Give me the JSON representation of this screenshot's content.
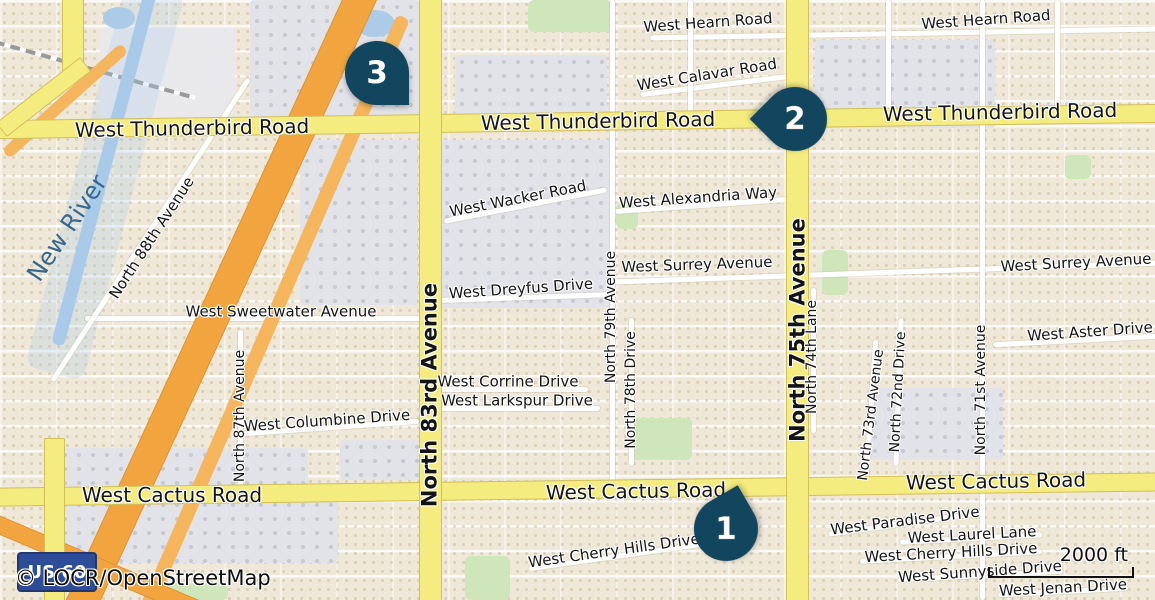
{
  "map": {
    "attribution": "© LOCR/OpenStreetMap",
    "scale": {
      "label": "2000 ft"
    },
    "shield": {
      "label": "US 60"
    },
    "colors": {
      "road_major_yellow": "#f5ec80",
      "highway_orange": "#f2a53f",
      "water_blue": "#a9c9e8",
      "marker_navy": "#12455e",
      "residential_beige": "#efe8d8",
      "commercial_gray": "#e2e3e8",
      "park_green": "#cfe6ba",
      "shield_blue": "#2e4d99",
      "river_label_blue": "#35688f"
    },
    "markers": [
      {
        "id": "1",
        "x": 726,
        "y": 529,
        "rot": -120
      },
      {
        "id": "2",
        "x": 795,
        "y": 119,
        "rot": 135
      },
      {
        "id": "3",
        "x": 377,
        "y": 73,
        "rot": 0
      }
    ],
    "features": [
      {
        "cls": "graylight",
        "name": "zone-riverside",
        "x": 100,
        "y": 28,
        "w": 135,
        "h": 100,
        "r": 0
      },
      {
        "cls": "gray",
        "name": "zone-commercial-nw",
        "x": 250,
        "y": 0,
        "w": 170,
        "h": 118,
        "r": 0
      },
      {
        "cls": "gray",
        "name": "zone-commercial-w83rd",
        "x": 300,
        "y": 140,
        "w": 118,
        "h": 165,
        "r": 0
      },
      {
        "cls": "gray",
        "name": "zone-commercial-e83rd",
        "x": 440,
        "y": 140,
        "w": 172,
        "h": 168,
        "r": 0
      },
      {
        "cls": "gray",
        "name": "zone-commercial-n-thunderbird",
        "x": 455,
        "y": 55,
        "w": 152,
        "h": 60,
        "r": 0
      },
      {
        "cls": "gray",
        "name": "zone-commercial-ne75th",
        "x": 815,
        "y": 40,
        "w": 180,
        "h": 88,
        "r": 0
      },
      {
        "cls": "gray",
        "name": "zone-commercial-center-east",
        "x": 868,
        "y": 388,
        "w": 135,
        "h": 72,
        "r": 0
      },
      {
        "cls": "gray",
        "name": "zone-commercial-cactus-nw",
        "x": 58,
        "y": 448,
        "w": 250,
        "h": 40,
        "r": 0
      },
      {
        "cls": "gray",
        "name": "zone-commercial-cactus-sw",
        "x": 58,
        "y": 498,
        "w": 280,
        "h": 65,
        "r": 0
      },
      {
        "cls": "gray",
        "name": "zone-commercial-cactus-83rd",
        "x": 340,
        "y": 440,
        "w": 80,
        "h": 40,
        "r": 0
      },
      {
        "cls": "green",
        "name": "park-top-center",
        "x": 528,
        "y": 0,
        "w": 84,
        "h": 32,
        "r": 0
      },
      {
        "cls": "green",
        "name": "park-alexandria",
        "x": 616,
        "y": 203,
        "w": 22,
        "h": 26,
        "r": 0
      },
      {
        "cls": "green",
        "name": "park-74th",
        "x": 822,
        "y": 250,
        "w": 26,
        "h": 45,
        "r": 0
      },
      {
        "cls": "green",
        "name": "park-center",
        "x": 632,
        "y": 418,
        "w": 60,
        "h": 42,
        "r": 0
      },
      {
        "cls": "green",
        "name": "park-bottom-center",
        "x": 465,
        "y": 556,
        "w": 45,
        "h": 44,
        "r": 0
      },
      {
        "cls": "green",
        "name": "park-right-top",
        "x": 1065,
        "y": 155,
        "w": 26,
        "h": 24,
        "r": 0
      },
      {
        "cls": "green",
        "name": "park-bottom-left",
        "x": 168,
        "y": 584,
        "w": 60,
        "h": 16,
        "r": 0
      },
      {
        "cls": "pond",
        "name": "pond-northwest",
        "x": 103,
        "y": 7,
        "w": 32,
        "h": 22,
        "r": 0
      },
      {
        "cls": "pond",
        "name": "pond-north",
        "x": 355,
        "y": 10,
        "w": 40,
        "h": 27,
        "r": 0
      },
      {
        "cls": "rail",
        "name": "railway",
        "x": -9,
        "y": 68,
        "w": 208,
        "h": 4,
        "r": 15.6
      },
      {
        "cls": "waterwide",
        "name": "new-river-floodway",
        "x": 75,
        "y": -20,
        "w": 60,
        "h": 400,
        "r": 14.8
      },
      {
        "cls": "water",
        "name": "new-river",
        "x": 98,
        "y": -17,
        "w": 13,
        "h": 368,
        "r": 14.8
      },
      {
        "cls": "street",
        "name": "west-hearn-road",
        "x": 650,
        "y": 31,
        "w": 507,
        "h": 5,
        "r": -1
      },
      {
        "cls": "street",
        "name": "west-calavar-road",
        "x": 640,
        "y": 83,
        "w": 150,
        "h": 5,
        "r": -7
      },
      {
        "cls": "street",
        "name": "west-wacker-road",
        "x": 443,
        "y": 203,
        "w": 165,
        "h": 5,
        "r": -11
      },
      {
        "cls": "street",
        "name": "west-alexandria-way",
        "x": 615,
        "y": 203,
        "w": 172,
        "h": 5,
        "r": -4
      },
      {
        "cls": "street",
        "name": "west-surrey-avenue",
        "x": 613,
        "y": 270,
        "w": 545,
        "h": 5,
        "r": -2
      },
      {
        "cls": "street",
        "name": "west-dreyfus-drive",
        "x": 440,
        "y": 295,
        "w": 172,
        "h": 5,
        "r": -2
      },
      {
        "cls": "street",
        "name": "west-sweetwater-avenue",
        "x": 85,
        "y": 316,
        "w": 345,
        "h": 5,
        "r": 0
      },
      {
        "cls": "street",
        "name": "west-aster-drive",
        "x": 993,
        "y": 338,
        "w": 165,
        "h": 5,
        "r": -3
      },
      {
        "cls": "street",
        "name": "west-corrine-drive",
        "x": 440,
        "y": 387,
        "w": 148,
        "h": 5,
        "r": 0
      },
      {
        "cls": "street",
        "name": "west-larkspur-drive",
        "x": 440,
        "y": 406,
        "w": 160,
        "h": 5,
        "r": 0
      },
      {
        "cls": "street",
        "name": "west-columbine-drive",
        "x": 243,
        "y": 425,
        "w": 176,
        "h": 5,
        "r": -4
      },
      {
        "cls": "street",
        "name": "west-cherry-hills-drive-c",
        "x": 528,
        "y": 554,
        "w": 175,
        "h": 5,
        "r": -8
      },
      {
        "cls": "street",
        "name": "west-paradise-drive",
        "x": 828,
        "y": 521,
        "w": 155,
        "h": 5,
        "r": -8
      },
      {
        "cls": "street",
        "name": "west-laurel-lane",
        "x": 900,
        "y": 536,
        "w": 142,
        "h": 5,
        "r": -3
      },
      {
        "cls": "street",
        "name": "west-cherry-hills-drive-r",
        "x": 860,
        "y": 554,
        "w": 182,
        "h": 5,
        "r": -3
      },
      {
        "cls": "street",
        "name": "west-sunnyside-drive",
        "x": 898,
        "y": 573,
        "w": 165,
        "h": 5,
        "r": -3
      },
      {
        "cls": "street",
        "name": "west-jenan-drive",
        "x": 998,
        "y": 589,
        "w": 130,
        "h": 5,
        "r": -3
      },
      {
        "cls": "street",
        "name": "north-87th-avenue",
        "x": 238,
        "y": 330,
        "w": 5,
        "h": 162,
        "r": 0
      },
      {
        "cls": "street",
        "name": "north-88th-avenue",
        "x": 148,
        "y": 50,
        "w": 5,
        "h": 360,
        "r": 33
      },
      {
        "cls": "street",
        "name": "north-79th-avenue",
        "x": 610,
        "y": 0,
        "w": 5,
        "h": 485,
        "r": 0
      },
      {
        "cls": "street",
        "name": "north-78th-drive",
        "x": 629,
        "y": 318,
        "w": 5,
        "h": 148,
        "r": 0
      },
      {
        "cls": "street",
        "name": "north-74th-lane",
        "x": 811,
        "y": 288,
        "w": 5,
        "h": 145,
        "r": 0
      },
      {
        "cls": "street",
        "name": "north-73rd-avenue",
        "x": 868,
        "y": 340,
        "w": 5,
        "h": 152,
        "r": 4
      },
      {
        "cls": "street",
        "name": "north-72nd-drive",
        "x": 896,
        "y": 318,
        "w": 5,
        "h": 148,
        "r": 2
      },
      {
        "cls": "street",
        "name": "north-71st-avenue",
        "x": 980,
        "y": 0,
        "w": 5,
        "h": 600,
        "r": 0
      },
      {
        "cls": "street",
        "name": "local-street-v1",
        "x": 688,
        "y": 0,
        "w": 5,
        "h": 118,
        "r": 0
      },
      {
        "cls": "street",
        "name": "local-street-v2",
        "x": 886,
        "y": 0,
        "w": 5,
        "h": 115,
        "r": 0
      },
      {
        "cls": "street",
        "name": "local-street-v3",
        "x": 1055,
        "y": 0,
        "w": 5,
        "h": 115,
        "r": 0
      },
      {
        "cls": "orange2",
        "name": "us60-ramp",
        "x": 267,
        "y": -10,
        "w": 14,
        "h": 650,
        "r": 23.5
      },
      {
        "cls": "orange",
        "name": "us60-freeway",
        "x": 205,
        "y": -50,
        "w": 30,
        "h": 700,
        "r": 24.7
      },
      {
        "cls": "orange",
        "name": "us60-ramp-southwest",
        "x": -20,
        "y": 557,
        "w": 230,
        "h": 16,
        "r": 23
      },
      {
        "cls": "orange2",
        "name": "ramp-northwest",
        "x": -15,
        "y": 95,
        "w": 160,
        "h": 12,
        "r": -42
      },
      {
        "cls": "yellow",
        "name": "west-thunderbird-road-band",
        "x": -8,
        "y": 112,
        "w": 1171,
        "h": 17,
        "r": -0.8
      },
      {
        "cls": "yellow",
        "name": "west-cactus-road-band",
        "x": -8,
        "y": 480,
        "w": 1171,
        "h": 17,
        "r": -0.75
      },
      {
        "cls": "yellow",
        "name": "north-83rd-avenue-band",
        "x": 419,
        "y": -6,
        "w": 21,
        "h": 612,
        "r": 0
      },
      {
        "cls": "yellow",
        "name": "north-75th-avenue-band",
        "x": 786,
        "y": -6,
        "w": 21,
        "h": 612,
        "r": 0
      },
      {
        "cls": "yellow",
        "name": "yellow-road-topleft",
        "x": 62,
        "y": -4,
        "w": 20,
        "h": 80,
        "r": 0
      },
      {
        "cls": "yellow",
        "name": "yellow-connector-topleft",
        "x": -10,
        "y": 88,
        "w": 105,
        "h": 16,
        "r": -38
      },
      {
        "cls": "yellow",
        "name": "yellow-road-bottomleft",
        "x": 44,
        "y": 438,
        "w": 19,
        "h": 165,
        "r": 0
      }
    ],
    "labels": [
      {
        "t": "West Hearn Road",
        "x": 708,
        "y": 23,
        "r": -4,
        "s": 15
      },
      {
        "t": "West Hearn Road",
        "x": 986,
        "y": 20,
        "r": -4,
        "s": 15
      },
      {
        "t": "West Calavar Road",
        "x": 707,
        "y": 75,
        "r": -9,
        "s": 15
      },
      {
        "t": "West Thunderbird Road",
        "x": 192,
        "y": 128,
        "r": -1,
        "s": 20
      },
      {
        "t": "West Thunderbird Road",
        "x": 598,
        "y": 121,
        "r": -1,
        "s": 20
      },
      {
        "t": "West Thunderbird Road",
        "x": 1000,
        "y": 112,
        "r": -1,
        "s": 20
      },
      {
        "t": "West Wacker Road",
        "x": 518,
        "y": 199,
        "r": -11,
        "s": 15
      },
      {
        "t": "West Alexandria Way",
        "x": 698,
        "y": 198,
        "r": -4,
        "s": 15
      },
      {
        "t": "West Surrey Avenue",
        "x": 697,
        "y": 265,
        "r": -2,
        "s": 15
      },
      {
        "t": "West Surrey Avenue",
        "x": 1076,
        "y": 263,
        "r": -3,
        "s": 15
      },
      {
        "t": "West Dreyfus Drive",
        "x": 521,
        "y": 289,
        "r": -4,
        "s": 15
      },
      {
        "t": "West Sweetwater Avenue",
        "x": 281,
        "y": 312,
        "r": 0,
        "s": 15
      },
      {
        "t": "West Aster Drive",
        "x": 1090,
        "y": 332,
        "r": -4,
        "s": 15
      },
      {
        "t": "West Corrine Drive",
        "x": 508,
        "y": 382,
        "r": 0,
        "s": 15
      },
      {
        "t": "West Larkspur Drive",
        "x": 517,
        "y": 401,
        "r": 0,
        "s": 15
      },
      {
        "t": "West Columbine Drive",
        "x": 327,
        "y": 421,
        "r": -4,
        "s": 15
      },
      {
        "t": "West Cactus Road",
        "x": 172,
        "y": 495,
        "r": 0,
        "s": 20
      },
      {
        "t": "West Cactus Road",
        "x": 636,
        "y": 491,
        "r": -1,
        "s": 20
      },
      {
        "t": "West Cactus Road",
        "x": 996,
        "y": 481,
        "r": -1,
        "s": 20
      },
      {
        "t": "West Paradise Drive",
        "x": 905,
        "y": 521,
        "r": -7,
        "s": 15
      },
      {
        "t": "West Laurel Lane",
        "x": 972,
        "y": 535,
        "r": -3,
        "s": 15
      },
      {
        "t": "West Cherry Hills Drive",
        "x": 951,
        "y": 553,
        "r": -3,
        "s": 15
      },
      {
        "t": "West Sunnyside Drive",
        "x": 980,
        "y": 572,
        "r": -4,
        "s": 15
      },
      {
        "t": "West Jenan Drive",
        "x": 1063,
        "y": 588,
        "r": -3,
        "s": 15
      },
      {
        "t": "West Cherry Hills Drive",
        "x": 614,
        "y": 551,
        "r": -8,
        "s": 15
      },
      {
        "t": "North 83rd Avenue",
        "x": 430,
        "y": 395,
        "r": -90,
        "s": 21,
        "b": 1
      },
      {
        "t": "North 75th Avenue",
        "x": 798,
        "y": 330,
        "r": -90,
        "s": 21,
        "b": 1
      },
      {
        "t": "North 88th Avenue",
        "x": 152,
        "y": 238,
        "r": -57,
        "s": 15
      },
      {
        "t": "North 87th Avenue",
        "x": 240,
        "y": 416,
        "r": -90,
        "s": 14
      },
      {
        "t": "North 79th Avenue",
        "x": 611,
        "y": 317,
        "r": -90,
        "s": 14
      },
      {
        "t": "North 78th Drive",
        "x": 631,
        "y": 390,
        "r": -90,
        "s": 14
      },
      {
        "t": "North 74th Lane",
        "x": 812,
        "y": 357,
        "r": -90,
        "s": 14
      },
      {
        "t": "North 73rd Avenue",
        "x": 871,
        "y": 415,
        "r": -83,
        "s": 14
      },
      {
        "t": "North 72nd Drive",
        "x": 898,
        "y": 392,
        "r": -87,
        "s": 14
      },
      {
        "t": "North 71st Avenue",
        "x": 981,
        "y": 390,
        "r": -90,
        "s": 14
      },
      {
        "t": "New River",
        "x": 67,
        "y": 228,
        "r": -56,
        "s": 24,
        "c": "#35688f"
      }
    ]
  }
}
